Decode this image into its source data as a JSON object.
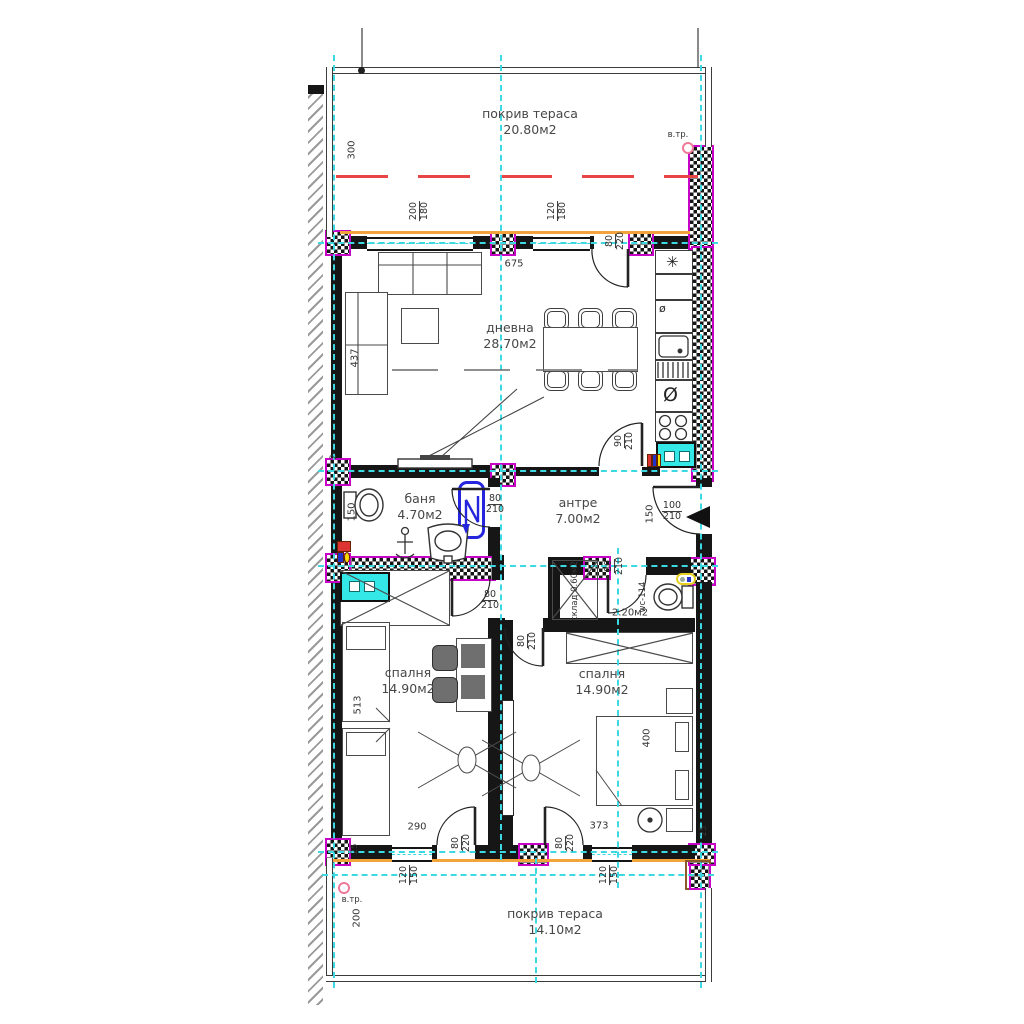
{
  "rooms": {
    "terrace_top": {
      "name": "покрив тераса",
      "area": "20.80м2"
    },
    "living": {
      "name": "дневна",
      "area": "28.70м2"
    },
    "bath": {
      "name": "баня",
      "area": "4.70м2"
    },
    "hall": {
      "name": "антре",
      "area": "7.00м2"
    },
    "storage": {
      "name": "склад",
      "area": "0.60м2"
    },
    "wc": {
      "name": "wc-114",
      "area": "2.20м2"
    },
    "bedroom_left": {
      "name": "спалня",
      "area": "14.90м2"
    },
    "bedroom_right": {
      "name": "спалня",
      "area": "14.90м2"
    },
    "terrace_bottom": {
      "name": "покрив тераса",
      "area": "14.10м2"
    }
  },
  "dims": {
    "terrace_top_depth": "300",
    "living_width": "675",
    "sofa_len": "437",
    "wall_thin": "2",
    "bath_left": "150",
    "hall_niche": "150",
    "bed_left_len": "513",
    "bed_right_len": "400",
    "bedroom_left_width": "290",
    "bedroom_right_width": "373",
    "terrace_bottom_depth": "200",
    "parapet_left": "25",
    "parapet_right": "25"
  },
  "openings": {
    "window_top_left": {
      "w": "200",
      "h": "180"
    },
    "window_top_right": {
      "w": "120",
      "h": "180"
    },
    "door_terrace_top": {
      "w": "80",
      "h": "220"
    },
    "door_living_hall": {
      "w": "90",
      "h": "210"
    },
    "door_bath": {
      "w": "80",
      "h": "210"
    },
    "door_entrance": {
      "w": "100",
      "h": "210"
    },
    "door_wc": {
      "w": "80",
      "h": "210"
    },
    "door_bedroom_left": {
      "w": "80",
      "h": "210"
    },
    "door_bedroom_right": {
      "w": "80",
      "h": "210"
    },
    "door_terrace_bl": {
      "w": "80",
      "h": "220"
    },
    "door_terrace_br": {
      "w": "80",
      "h": "220"
    },
    "window_bottom_left": {
      "w": "120",
      "h": "150"
    },
    "window_bottom_right": {
      "w": "120",
      "h": "150"
    }
  },
  "annotations": {
    "vtr_top": "в.тр.",
    "vtr_bottom": "в.тр."
  },
  "icons": {
    "fridge": "✳",
    "cabinet_small": "ø",
    "cooktop": "Ø"
  },
  "colors": {
    "wall": "#161616",
    "axis_cyan": "#3cd9e2",
    "hatch_magenta": "#c803c8",
    "red_line": "#e84545",
    "orange_line": "#f2a33c",
    "appliance_cyan": "#35e8e8",
    "boiler_blue": "#2525dd",
    "pink_marker": "#f07898",
    "brown_outline": "#8a5a2a"
  }
}
